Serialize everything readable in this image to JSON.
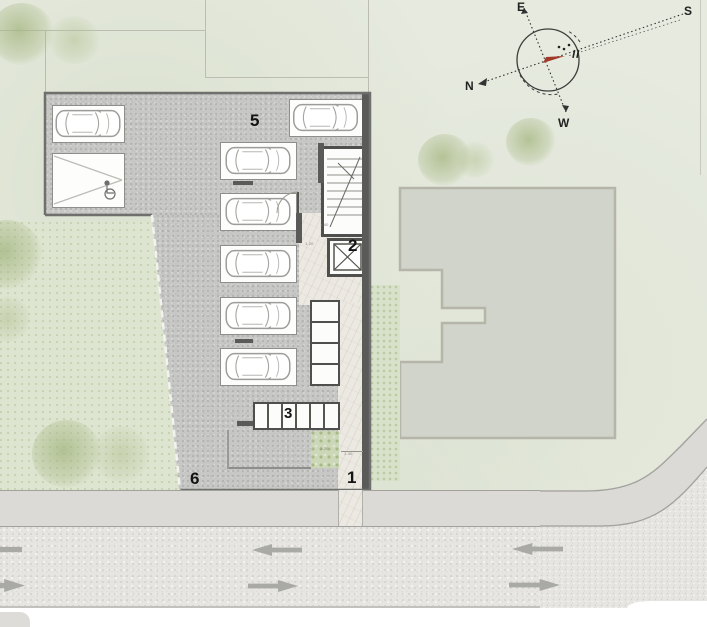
{
  "plan_title": "ground floor site plan",
  "zones": {
    "entrance": "1",
    "core": "2",
    "bike_row": "3",
    "ramp": "5",
    "lot": "6"
  },
  "compass": {
    "north": "N",
    "south": "S",
    "east": "E",
    "west": "W"
  },
  "dimensions": {
    "lobby": "1.40",
    "corridor": "1.20",
    "planter": "2.20",
    "walkway": "1.40"
  },
  "counts": {
    "cars_parked": 7,
    "bike_stalls": 6,
    "storage_units": 4
  },
  "colors": {
    "grass": "#e6eadf",
    "garden": "#dde4d0",
    "asphalt": "#c7c7c5",
    "road": "#e6e5e2",
    "sidewalk": "#dbdad6",
    "building": "#d0d4cb",
    "marble": "#ece9e2",
    "planter_green": "#ccd7b8",
    "wall": "#5a5a58",
    "needle_red": "#a23828",
    "arrow_gray": "#a9a9a6"
  }
}
